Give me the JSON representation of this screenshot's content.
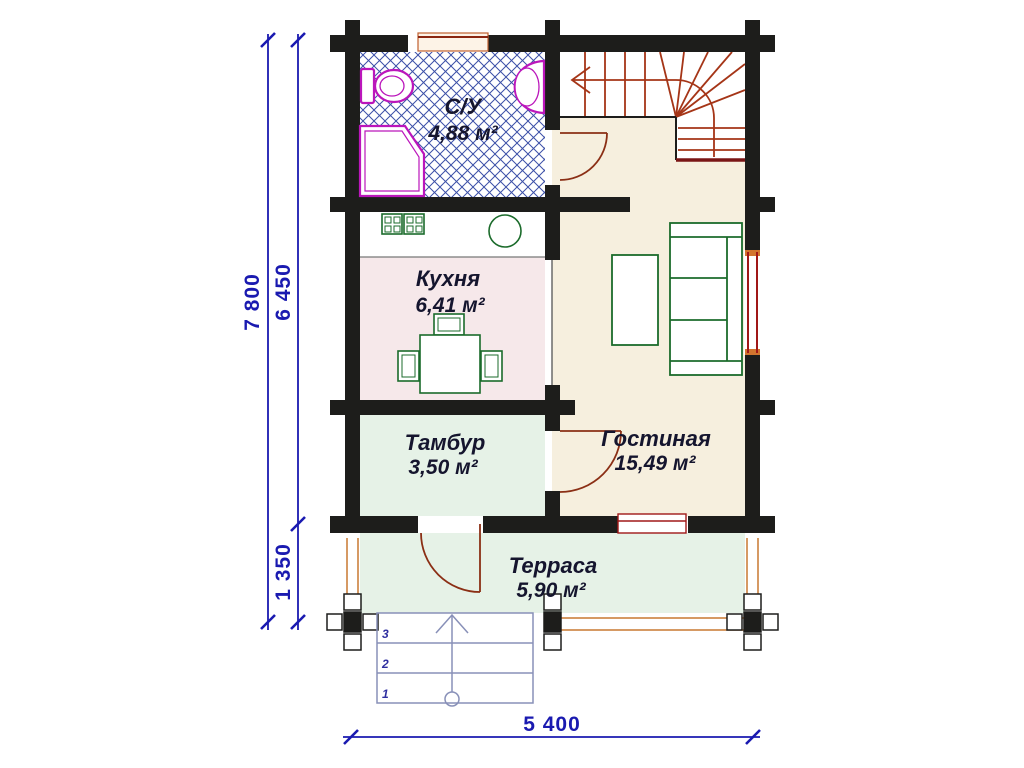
{
  "plan": {
    "type": "floor-plan",
    "rooms": [
      {
        "name": "С/У",
        "area": "4,88 м²"
      },
      {
        "name": "Кухня",
        "area": "6,41 м²"
      },
      {
        "name": "Тамбур",
        "area": "3,50 м²"
      },
      {
        "name": "Гостиная",
        "area": "15,49 м²"
      },
      {
        "name": "Терраса",
        "area": "5,90 м²"
      }
    ],
    "dimensions": {
      "height_total": "7 800",
      "height_main": "6 450",
      "height_terrace": "1 350",
      "width_bottom": "5 400"
    },
    "entry_steps": {
      "numbers": [
        "1",
        "2",
        "3"
      ]
    },
    "colors": {
      "wall": "#1d1d1b",
      "dimension": "#1a1ab0",
      "stair_tread": "#a53517",
      "stair_edge": "#7a1515",
      "door": "#8b2f15",
      "window": "#a01818",
      "window_accent": "#d2752f",
      "fixture": "#bb16bb",
      "furniture": "#1b6b2b",
      "hatch": "#3c50a8",
      "floor_kitchen": "#f6e8ea",
      "floor_living": "#f6efde",
      "floor_green": "#e6f2e7",
      "railing": "#c87830",
      "steps": "#8890b8",
      "room_text": "#15152e"
    }
  }
}
